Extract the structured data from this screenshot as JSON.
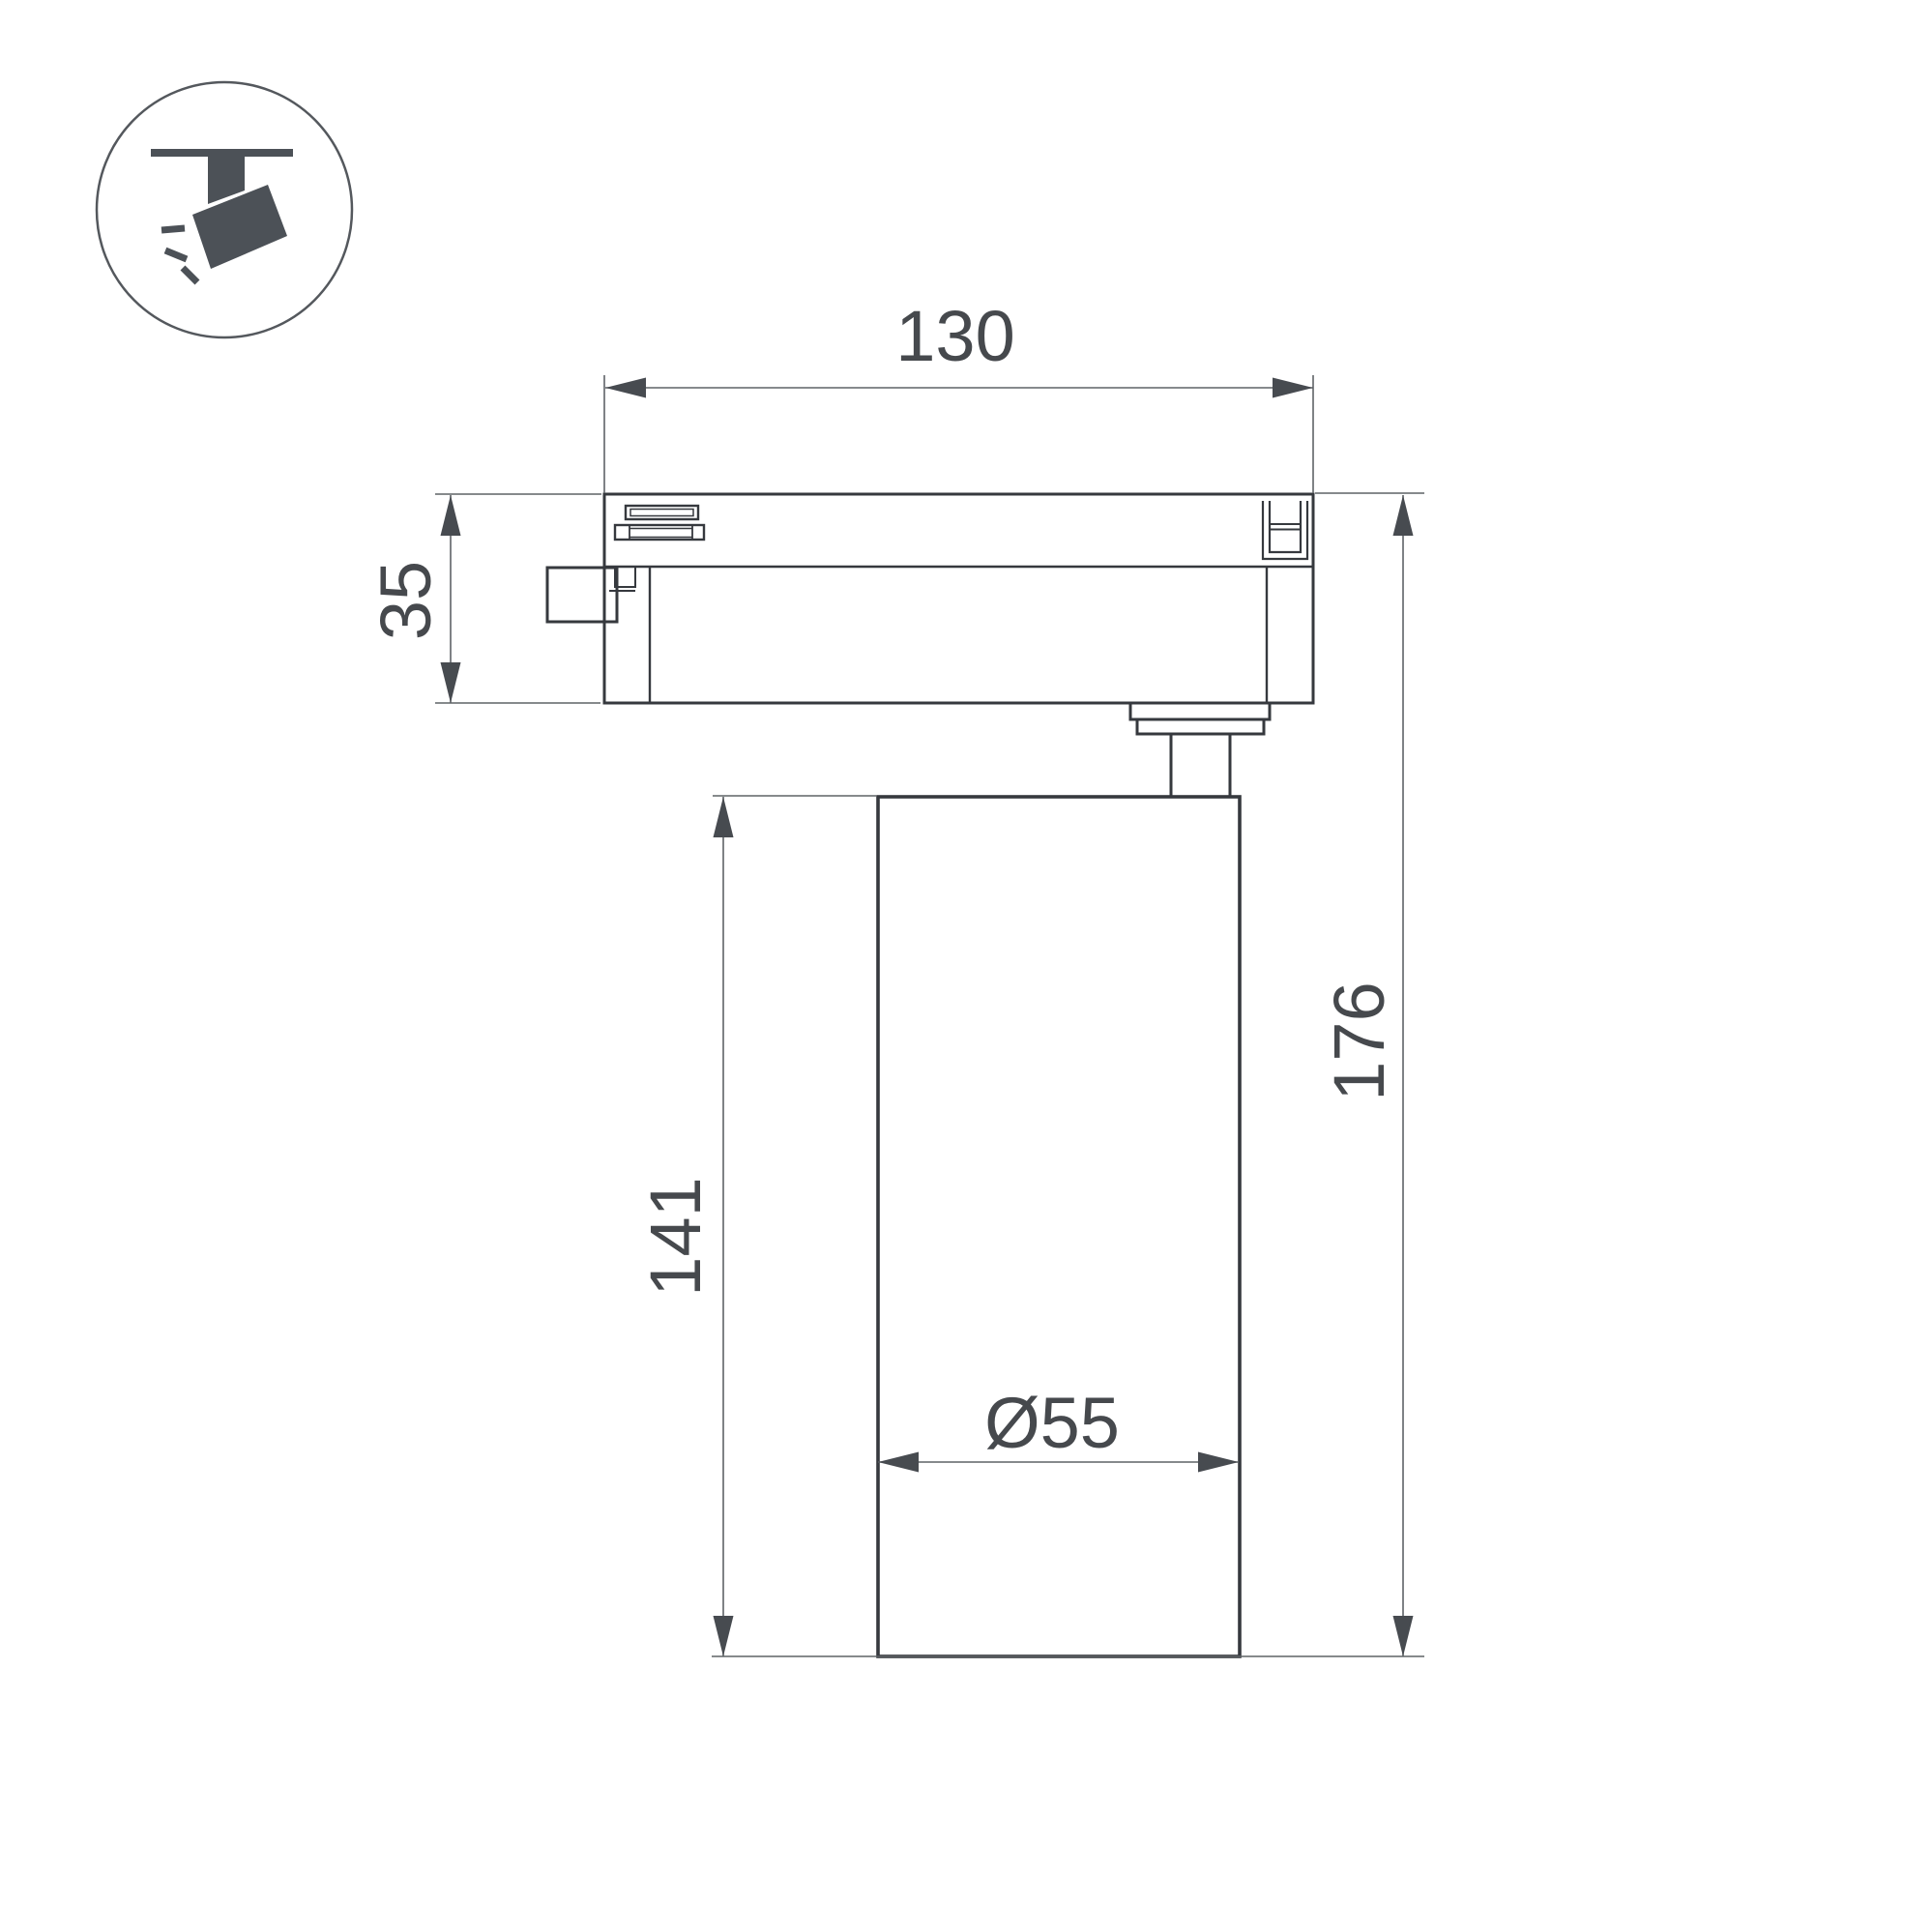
{
  "page": {
    "background": "#ffffff",
    "kind": "technical dimension drawing of track-mounted spotlight"
  },
  "icon": {
    "name": "track-spotlight-icon",
    "glyph_color": "#4c5157",
    "circle_stroke": "#54585d"
  },
  "drawing": {
    "outline_color": "#36393e",
    "dimension_line_color": "#5f6367",
    "arrow_color": "#474b50",
    "text_color": "#46494d",
    "labels": {
      "adapter_width": "130",
      "adapter_height": "35",
      "body_height": "141",
      "total_height": "176",
      "body_diameter": "Ø55"
    }
  }
}
